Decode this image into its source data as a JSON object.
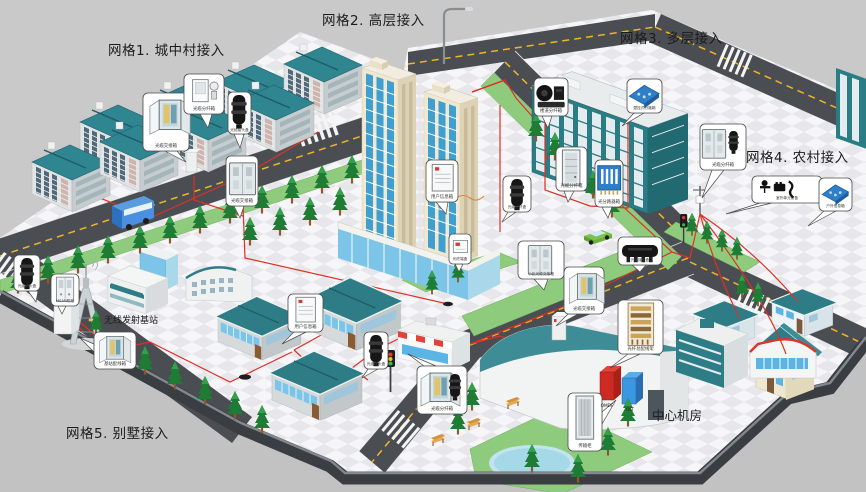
{
  "grid_labels": {
    "grid1": "网格1. 城中村接入",
    "grid2": "网格2. 高层接入",
    "grid3": "网格3. 多层接入",
    "grid4": "网格4. 农村接入",
    "grid5": "网格5. 别墅接入"
  },
  "facility_labels": {
    "wireless_base_station": "无线发射基站",
    "central_office": "中心机房",
    "omdf": "OMDF",
    "olt": "OLT"
  },
  "callouts": {
    "c1": "光缆交接箱",
    "c2": "光缆分纤箱",
    "c3": "光缆接头盒",
    "c4": "光缆交接箱",
    "c5": "用户信息箱",
    "c6": "光终端盒",
    "c7": "光缆分纤盒",
    "c8": "楼道分纤箱",
    "c9": "壁挂式分路箱",
    "c10": "光缆分纤箱",
    "c11": "光分路器箱",
    "c12": "小区光缆交接箱",
    "c13": "光缆接头盒",
    "c14": "光缆交接箱",
    "c15": "光缆分纤箱",
    "c16": "室外单元设备",
    "c17": "户外信息箱",
    "c18": "光缆接头盒",
    "c19": "MSAN机柜",
    "c20": "基站配线箱",
    "c21": "用户信息箱",
    "c22": "光缆接头盒",
    "c23": "光缆分纤箱",
    "c24": "传输柜",
    "c25": "光纤总配线架"
  },
  "colors": {
    "background": "#c9c9c9",
    "plaza": "#f6f6f8",
    "plaza_diamond": "#e6e6eb",
    "road": "#4a4e52",
    "road_centerline": "#f0b428",
    "fiber": "#e03024",
    "roof_teal": "#2e7d86",
    "lawn": "#8fcb7c",
    "highrise_wall": "#efe8d0",
    "highrise_glass": "#3f9fd0",
    "omdf_cabinet": "#cc2a22",
    "olt_cabinet": "#3b97e0"
  }
}
